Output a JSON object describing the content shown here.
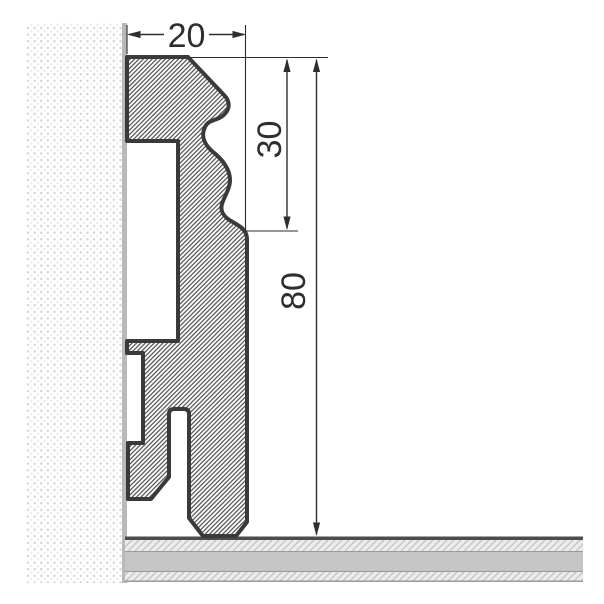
{
  "diagram": {
    "type": "technical-cross-section",
    "subject": "skirting-board-profile-on-wall-and-floor",
    "dimensions": {
      "width_label": "20",
      "upper_height_label": "30",
      "total_height_label": "80"
    }
  },
  "colors": {
    "background": "#ffffff",
    "outline": "#3a3a3a",
    "hatch-line": "#4a4a4a",
    "dimension-line": "#2e2e2e",
    "text": "#2e2e2e",
    "wall-dot-dark": "#d2d2d2",
    "wall-dot-light": "#e9e9e9",
    "wall-edge": "#b9b9b9",
    "floor-core": "#c6c6c6",
    "floor-hatch-bg": "#ececec",
    "floor-hatch-line": "#c2c2c2",
    "floor-border": "#4d4d4d",
    "floor-line": "#9a9a9a"
  }
}
